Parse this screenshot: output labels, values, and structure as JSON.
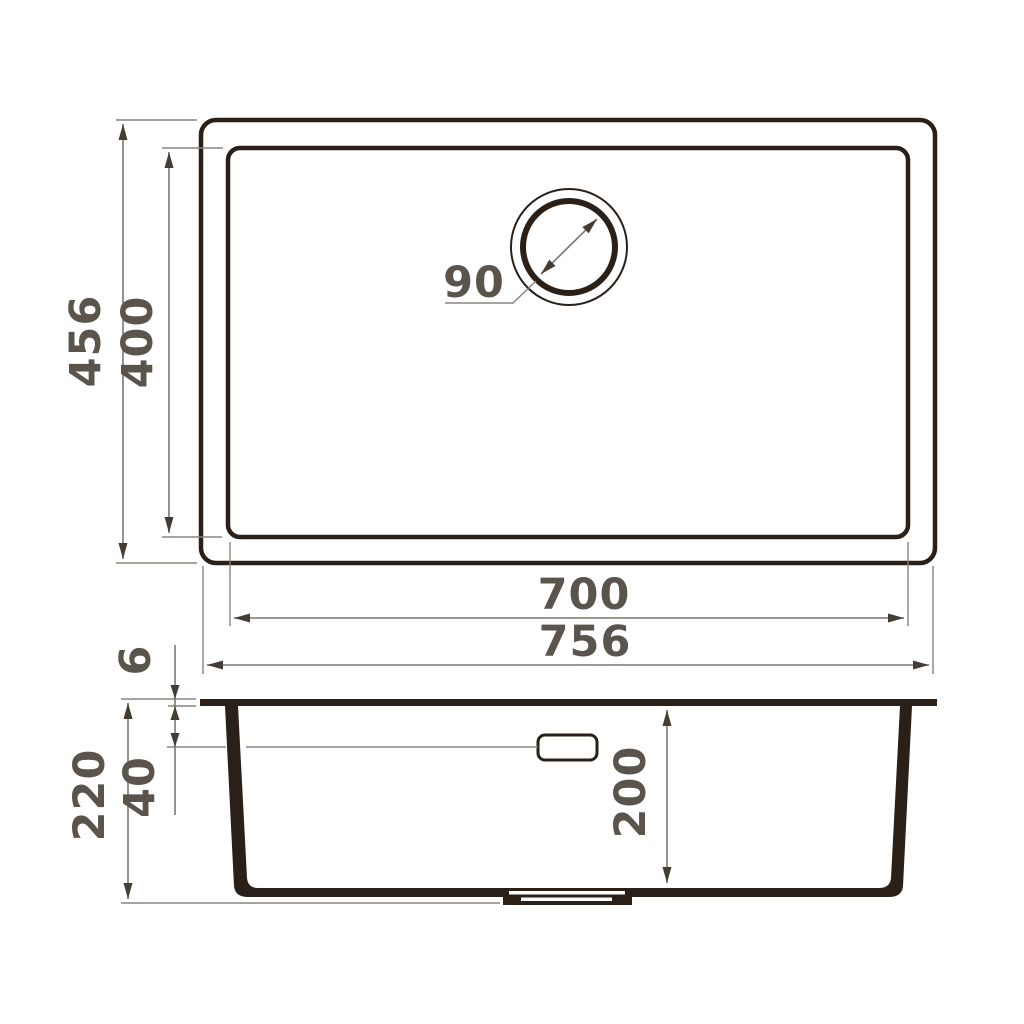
{
  "drawing": {
    "title": "undermount-sink-technical-drawing",
    "colors": {
      "outline": "#2b2017",
      "dimension_lines": "#7d766e",
      "dimension_text": "#5a544d",
      "background": "#ffffff"
    },
    "top_view": {
      "outer_width": "756",
      "outer_height": "456",
      "inner_width": "700",
      "inner_height": "400",
      "drain_diameter": "90"
    },
    "side_view": {
      "rim_thickness": "6",
      "overflow_offset": "40",
      "overall_depth": "220",
      "bowl_depth": "200"
    }
  }
}
